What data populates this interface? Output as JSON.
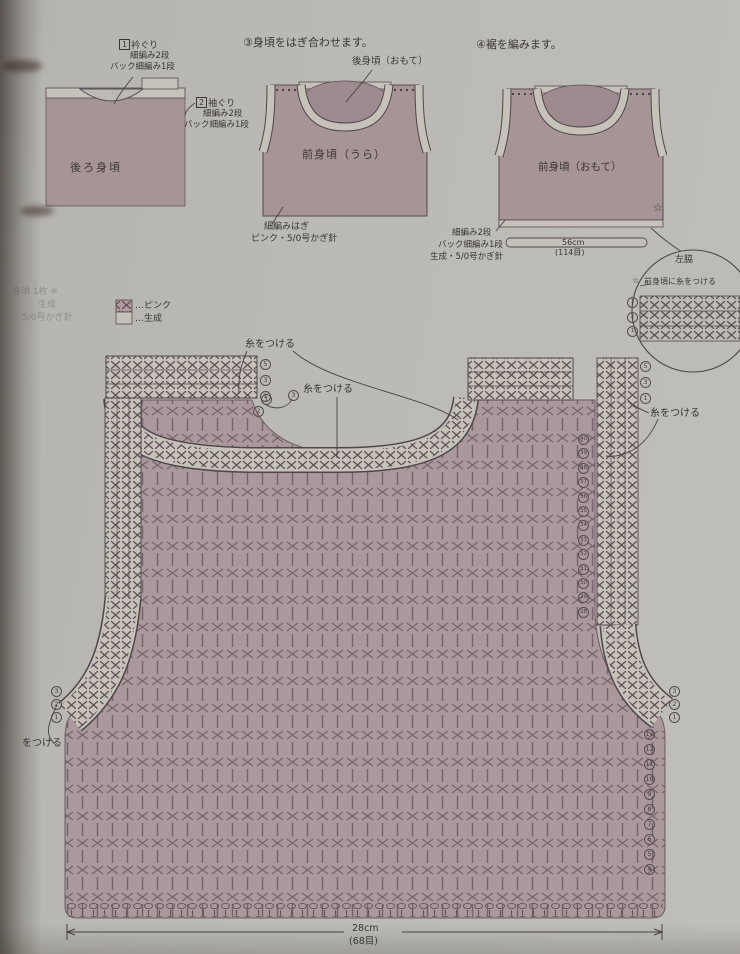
{
  "colors": {
    "paper": "#bbbab4",
    "pink_fill": "#a89697",
    "body_pink": "#ab989c",
    "ecru": "#c6c2ba",
    "stitch_dark": "#5e5156",
    "ink": "#3b3537"
  },
  "back_diagram": {
    "label": "後ろ身頃",
    "c1_num": "1",
    "c1_title": "衿ぐり",
    "c1_l1": "細編み2段",
    "c1_l2": "バック細編み1段",
    "c2_num": "2",
    "c2_title": "袖ぐり",
    "c2_l1": "細編み2段",
    "c2_l2": "バック細編み1段"
  },
  "join_diagram": {
    "title": "③身頃をはぎ合わせます。",
    "back_label": "後身頃（おもて）",
    "front_label": "前身頃（うら）",
    "c_l1": "細編みはぎ",
    "c_l2": "ピンク・5/0号かぎ針"
  },
  "hem_diagram": {
    "title": "④裾を編みます。",
    "front_label": "前身頃（おもて）",
    "width": "56cm",
    "stitches": "(114目)",
    "c_l1": "細編み2段",
    "c_l2": "バック細編み1段",
    "c_l3": "生成・5/0号かぎ針",
    "star": "☆"
  },
  "side_detail": {
    "title": "左脇",
    "star": "☆",
    "note": "前身頃に糸をつける",
    "rows": [
      "3",
      "2",
      "1"
    ]
  },
  "legend": {
    "faded_l1": "身頃 1枚 ※",
    "faded_l2": "生成",
    "faded_l3": "5/0号かぎ針",
    "pink": "…ピンク",
    "ecru": "…生成"
  },
  "chart": {
    "attach1": "糸をつける",
    "attach2": "糸をつける",
    "attach3": "糸をつける",
    "attach4": "をつける",
    "shoulder_left_rows": [
      "5",
      "3",
      "1"
    ],
    "shoulder_right_rows": [
      "5",
      "3",
      "1"
    ],
    "neck_marks": [
      "3",
      "1",
      "2"
    ],
    "right_upper_rows": [
      "40",
      "39",
      "38",
      "37",
      "36",
      "35",
      "34",
      "33",
      "32",
      "31",
      "30",
      "29",
      "28"
    ],
    "right_lower_rows": [
      "13",
      "12",
      "11",
      "10",
      "9",
      "8",
      "7",
      "6",
      "5",
      "4"
    ],
    "armhole_right_rows": [
      "3",
      "2",
      "1"
    ],
    "armhole_left_rows": [
      "3",
      "2",
      "1"
    ],
    "width": "28cm",
    "stitches": "(68目)"
  }
}
